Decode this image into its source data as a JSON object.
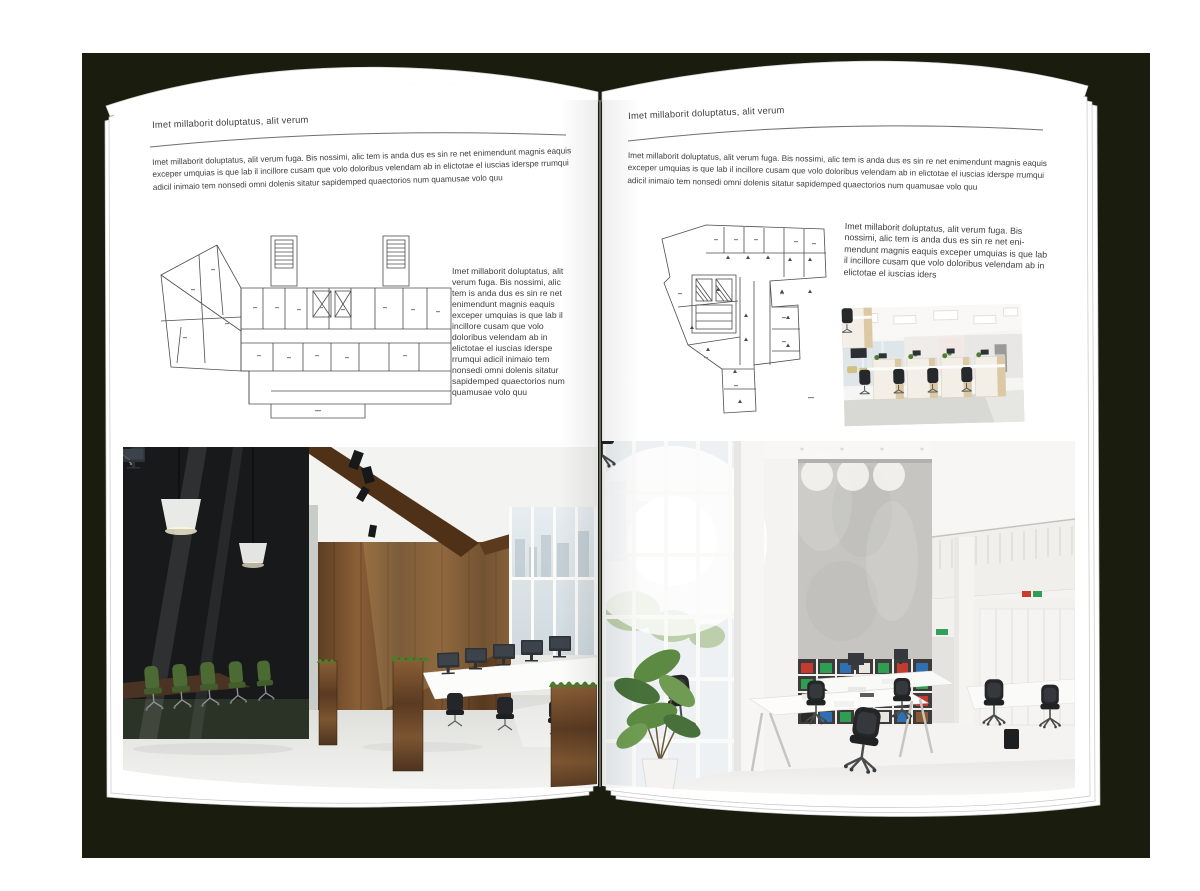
{
  "book": {
    "left_page": {
      "header": "Imet millaborit doluptatus, alit verum",
      "intro": "Imet millaborit doluptatus, alit verum fuga. Bis nossimi, alic tem is anda dus es sin re net enimendunt magnis eaquis exceper umquias is que lab il incillore cusam que volo doloribus velendam ab in elictotae el iuscias iderspe rrumqui adicil inimaio tem nonsedi omni dolenis sitatur sapidemped quaectorios num quamusae volo quu",
      "caption": "Imet millaborit doluptatus, alit verum fuga. Bis nossimi, alic tem is anda dus es sin re net enimendunt magnis eaquis exceper umquias is que lab il incillore cusam que volo doloribus velendam ab in elictotae el iuscias iderspe rrumqui adicil inimaio tem nonsedi omni dolenis sitatur sapidemped quaectorios num quamusae volo quu",
      "figures": {
        "floor_plan": "building floor plan drawing",
        "photo": "dark office interior with glass meeting room and wood wall"
      }
    },
    "right_page": {
      "header": "Imet millaborit doluptatus, alit verum",
      "intro": "Imet millaborit doluptatus, alit verum fuga. Bis nossimi, alic tem is anda dus es sin re net enimendunt magnis eaquis exceper umquias is que lab il incillore cusam que volo doloribus velendam ab in elictotae el iuscias iderspe rrumqui adicil inimaio tem nonsedi omni dolenis sitatur sapidemped quaectorios num quamusae volo quu",
      "caption": "Imet millaborit doluptatus, alit verum fuga. Bis nossimi, alic tem is anda dus es sin re net eni­mendunt magnis eaquis exceper umquias is que lab il incillore cusam que volo doloribus velendam ab in elictotae el iuscias iders",
      "figures": {
        "floor_plan": "irregular building floor plan drawing",
        "photo_small": "open office cubicles with black chairs",
        "photo_large": "bright double-height office with bookshelves"
      }
    }
  },
  "colors": {
    "backdrop": "#1a1c0e",
    "page": "#ffffff",
    "text": "#3e3e3e",
    "rule": "#6f6f6f"
  }
}
